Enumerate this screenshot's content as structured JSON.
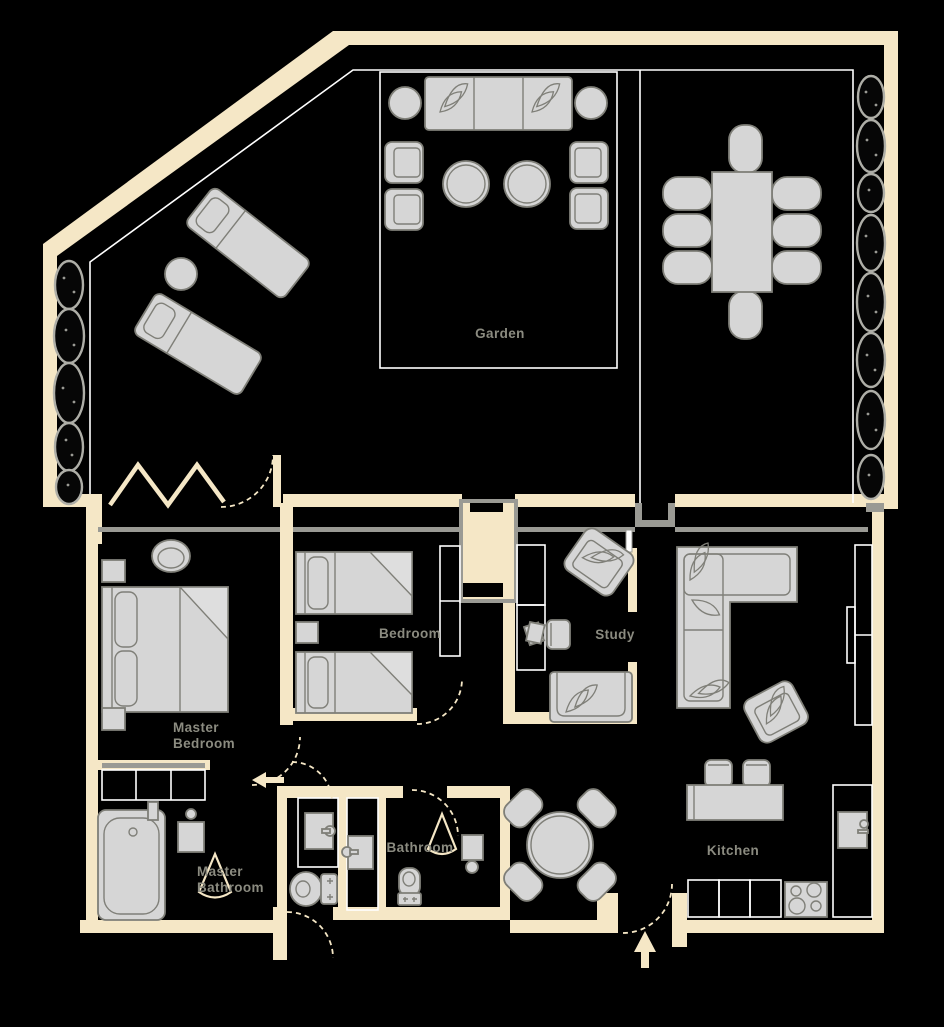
{
  "title": "Apartment floor plan with garden",
  "colors": {
    "background": "#000000",
    "wall": "#f5e7c6",
    "structure_gray": "#9a9a94",
    "furniture_fill": "#d6d6d6",
    "furniture_stroke": "#7f7f78",
    "inner_line": "#ffffff",
    "label_text": "#8b8b80"
  },
  "rooms": {
    "garden": {
      "label": "Garden"
    },
    "bedroom": {
      "label": "Bedroom"
    },
    "master_bedroom": {
      "label_line1": "Master",
      "label_line2": "Bedroom"
    },
    "study": {
      "label": "Study"
    },
    "kitchen": {
      "label": "Kitchen"
    },
    "bathroom": {
      "label": "Bathroom"
    },
    "master_bathroom": {
      "label_line1": "Master",
      "label_line2": "Bathroom"
    }
  },
  "symbols": [
    {
      "name": "entry-arrow-icon",
      "meaning": "entrance direction, pointing up"
    },
    {
      "name": "hallway-arrow-icon",
      "meaning": "circulation direction, pointing left"
    },
    {
      "name": "door-swing-arc",
      "meaning": "hinged door swing"
    },
    {
      "name": "bifold-door",
      "meaning": "folding terrace door"
    },
    {
      "name": "shower-spray-icon",
      "meaning": "shower head spray"
    },
    {
      "name": "hedge-icon",
      "meaning": "garden hedge / shrubs"
    }
  ],
  "furniture_inventory": [
    {
      "area": "Garden",
      "items": [
        "outdoor sofa",
        "2 planters",
        "4 lounge armchairs",
        "2 round coffee tables",
        "dining table",
        "8 dining chairs",
        "2 sun loungers",
        "round side table",
        "hedges"
      ]
    },
    {
      "area": "Master Bedroom",
      "items": [
        "double bed",
        "2 nightstands",
        "oval ottoman",
        "wardrobe"
      ]
    },
    {
      "area": "Bedroom",
      "items": [
        "2 single beds",
        "nightstand",
        "closet"
      ]
    },
    {
      "area": "Study",
      "items": [
        "desk with shelving",
        "desk chair",
        "papers",
        "armchair",
        "loveseat"
      ]
    },
    {
      "area": "Living area",
      "items": [
        "corner sofa",
        "armchair",
        "built-in cabinet",
        "tv"
      ]
    },
    {
      "area": "Kitchen",
      "items": [
        "round dining table",
        "4 chairs",
        "counter",
        "2 bar stools",
        "base cabinets",
        "cooktop",
        "sink"
      ]
    },
    {
      "area": "Master Bathroom",
      "items": [
        "bathtub",
        "wall sink",
        "shower",
        "toilet",
        "vanity sink"
      ]
    },
    {
      "area": "Bathroom",
      "items": [
        "toilet",
        "shower",
        "sink"
      ]
    }
  ]
}
